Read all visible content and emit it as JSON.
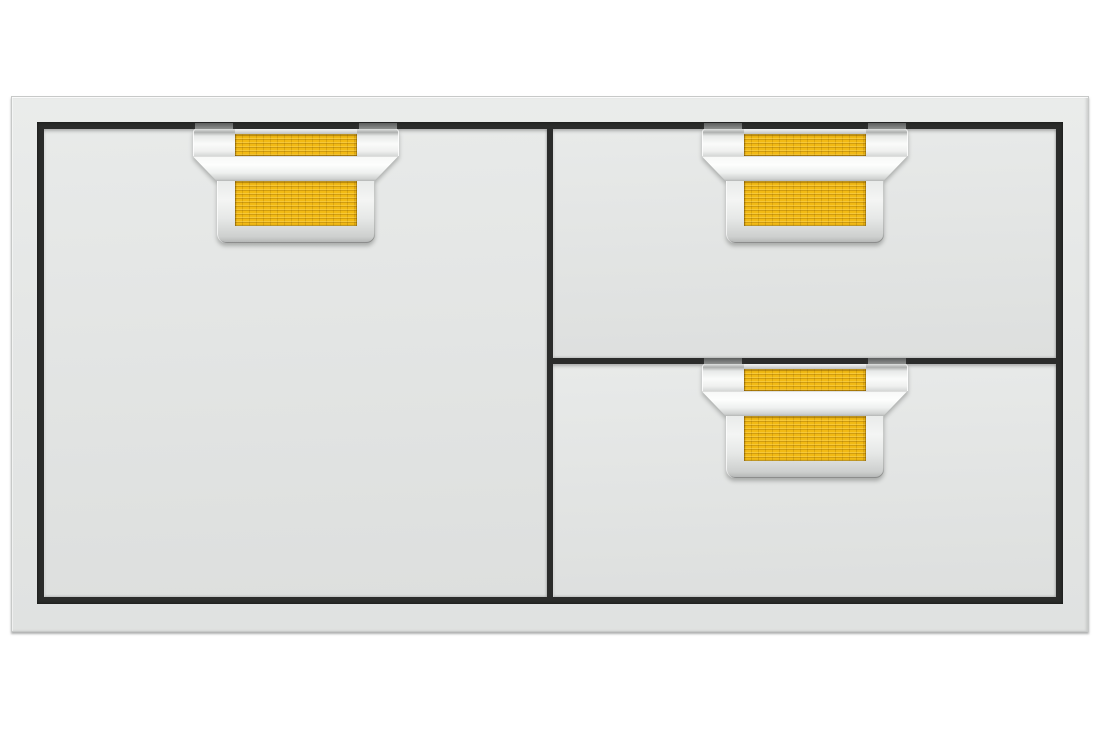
{
  "scene": {
    "description": "Front product view of a stainless steel built-in storage combo: one access door on the left and two stacked drawers on the right, each fitted with a chrome handle over a yellow honeycomb-textured accent panel.",
    "background_color": "#ffffff"
  },
  "unit": {
    "frame_color": "#e5e7e6",
    "panel_color": "#e3e5e4",
    "recess_color": "#2b2c2b",
    "accent_color": "#f2ba14",
    "chrome_highlight": "#fafbfa",
    "mount_tab_color": "#8a8c8b",
    "components": [
      {
        "id": "door",
        "label": "storage access door with yellow accent handle"
      },
      {
        "id": "drawer-top",
        "label": "top storage drawer with yellow accent handle"
      },
      {
        "id": "drawer-bottom",
        "label": "bottom storage drawer with yellow accent handle"
      }
    ]
  }
}
